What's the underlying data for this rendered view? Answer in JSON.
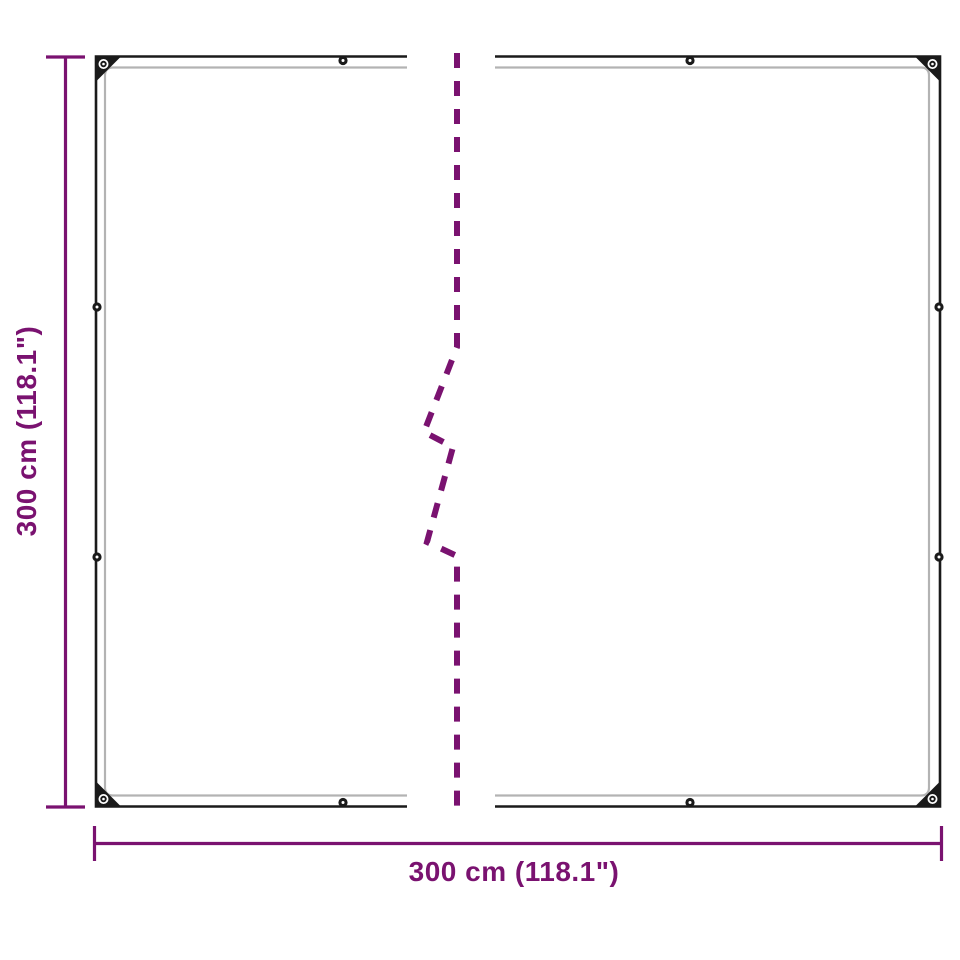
{
  "diagram": {
    "width_label": "300 cm (118.1\")",
    "height_label": "300 cm (118.1\")",
    "colors": {
      "accent": "#7A1270",
      "outline": "#1A1A1A",
      "inner_line": "#B3B3B3",
      "background": "#FFFFFF"
    }
  }
}
